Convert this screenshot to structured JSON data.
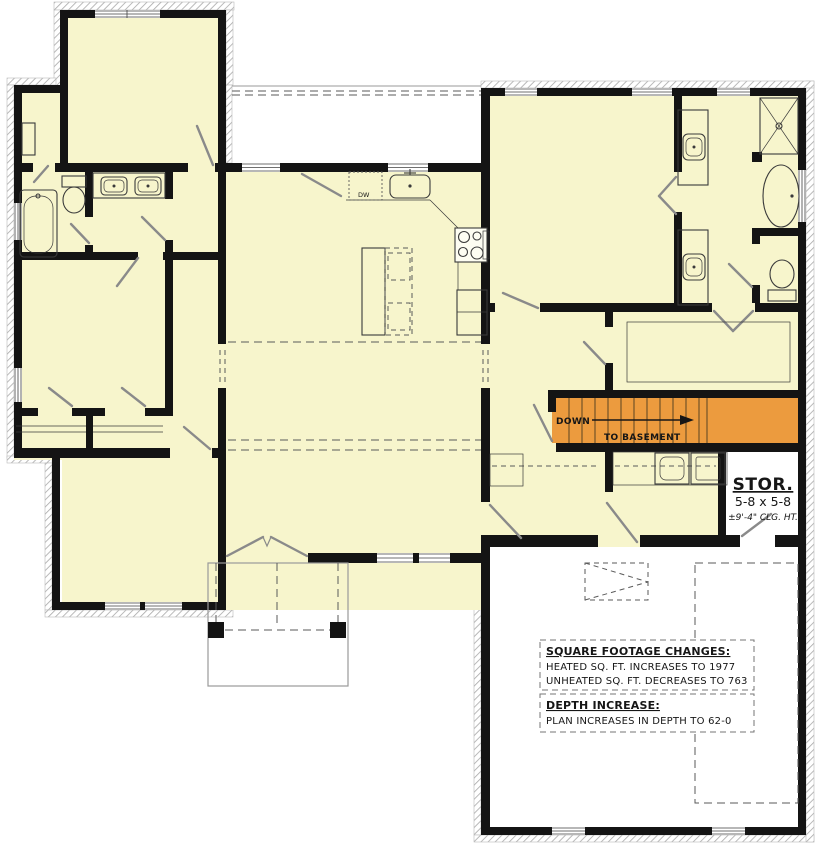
{
  "colors": {
    "heated": "#F7F5CC",
    "unheated": "#FFFFFF",
    "wall": "#141414",
    "stairs": "#EC9B3E",
    "dashed": "#5a5a5a",
    "fixture": "#3a3a3a",
    "door": "#8a8a8a",
    "slab": "#9a9a9a"
  },
  "stairs": {
    "down": "DOWN",
    "to_basement": "TO BASEMENT"
  },
  "storage": {
    "title": "STOR.",
    "size": "5-8 x 5-8",
    "ceiling": "±9'-4\" CLG. HT."
  },
  "kitchen": {
    "dishwasher": "DW"
  },
  "notes": {
    "sqft_title": "SQUARE FOOTAGE CHANGES:",
    "sqft_line1": "HEATED SQ. FT. INCREASES TO 1977",
    "sqft_line2": "UNHEATED SQ. FT. DECREASES TO 763",
    "depth_title": "DEPTH INCREASE:",
    "depth_line": "PLAN INCREASES IN DEPTH TO 62-0"
  }
}
